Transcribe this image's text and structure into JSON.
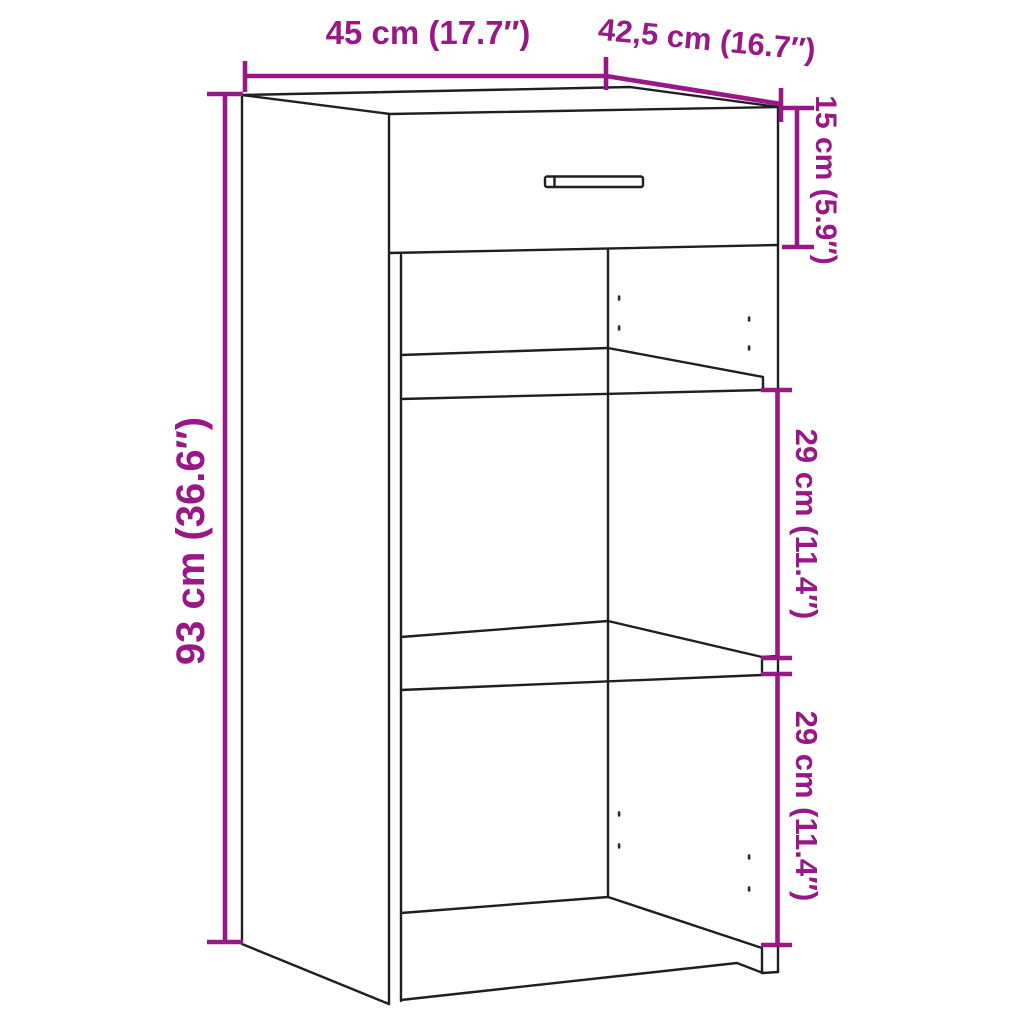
{
  "diagram": {
    "subject": "cabinet with top drawer, two shelves and open compartments",
    "colors": {
      "dimension_accent": "#981886",
      "outline": "#1f1f1f",
      "background": "#ffffff"
    },
    "labels": {
      "width": "45 cm (17.7″)",
      "depth": "42,5 cm (16.7″)",
      "drawer_section_height": "15 cm (5.9″)",
      "total_height": "93 cm (36.6″)",
      "upper_compartment_height": "29 cm (11.4″)",
      "lower_compartment_height": "29 cm (11.4″)"
    }
  }
}
